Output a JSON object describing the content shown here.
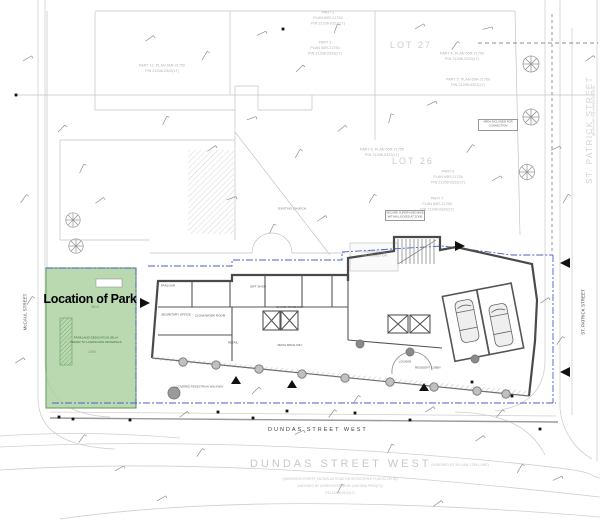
{
  "park": {
    "label": "Location of Park",
    "dim_top": "5815",
    "dim_mid": "1300",
    "note1": "PARKLAND DEDICATION 281m²",
    "note2": "REFER TO LANDSCAPE DRAWINGS"
  },
  "streets": {
    "mccaul": "McCAUL STREET",
    "st_patrick_small": "ST. PATRICK STREET",
    "st_patrick_outline": "ST. PATRICK STREET",
    "st_patrick_bylaw": "(BY BY-LAW 7435-UNREGISTERED)",
    "dundas_plan": "DUNDAS STREET WEST",
    "dundas_survey": "DUNDAS STREET WEST",
    "dundas_widened": "(WIDENED BY BY-LAW 1789-LANE)",
    "dundas_note1": "(ANDERSON STREET SHOWN AS ROAD ON REGISTERED PLAN 63 OR 30)",
    "dundas_note2": "(WIDENED BY UNREGISTERED BY-LAW 0808 PR53(LT))",
    "dundas_pin": "PIN 21208-0310(LT)"
  },
  "parcels": {
    "part2": [
      "PART 2",
      "PLAN 66R-21750",
      "PIN 21208-0321(LT)"
    ],
    "part3": [
      "PART 3",
      "PLAN 66R-21750",
      "PIN 21208-0320(LT)"
    ],
    "part4": [
      "PART 4, PLAN 66R-21750",
      "PIN 21208-0320(LT)"
    ],
    "part5": [
      "PART 5, PLAN 66R-21750",
      "PIN 21208-0322(LT)"
    ],
    "part6": [
      "PART 6",
      "PLAN 66R-21755",
      "PIN 21208-0322(LT)"
    ],
    "part7": [
      "PART 7",
      "PLAN 66R-21755",
      "PIN 21208-0320(LT)"
    ],
    "part8": [
      "PART 8, PLAN 66R-21755",
      "PIN 21208-0322(LT)"
    ],
    "part12": [
      "PART 12, PLAN 66R-21750",
      "PIN 21208-0320(LT)"
    ],
    "lot26": "LOT 26",
    "lot27": "LOT 27"
  },
  "building": {
    "existing_church": "EXISTING CHURCH",
    "walkway": "COVERED PEDESTRIAN WALKWAY",
    "bike_box": [
      "SECURE SUPERVISED BIKE",
      "WITHIN LOCKED AT ZONE"
    ],
    "connection_box": [
      "AREA INCLUDED FOR",
      "CONNECTION"
    ],
    "connection_mid": [
      "AREA INCLUDED",
      "FOR CONNECTION"
    ],
    "rooms": {
      "parlour": "PARLOUR",
      "gift_shop": "GIFT SHOP",
      "secretary": "SECRETARY OFFICE",
      "work_room": "CLOAK/WORK ROOM",
      "retail": "RETAIL",
      "church_elev": "CHURCH SPACE ONLY",
      "retail_elev": "RETAIL SPACE ONLY",
      "lounge": "LOUNGE",
      "resident_lobby": "RESIDENT LOBBY"
    }
  },
  "colors": {
    "park_fill": "#a9cf9e",
    "park_border": "#6aa05e",
    "blue": "#4a5fc9",
    "wall": "#4a4a4a"
  }
}
